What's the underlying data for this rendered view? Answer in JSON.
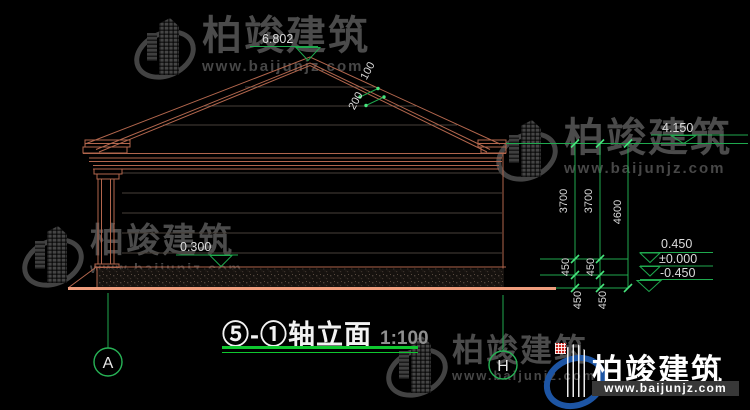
{
  "watermark": {
    "brand": "柏竣建筑",
    "url": "www.baijunjz.com"
  },
  "title_block": {
    "title": "⑤-①轴立面",
    "scale": "1:100"
  },
  "axis_bubbles": {
    "left": "A",
    "right": "H"
  },
  "levels": {
    "ridge": "6.802",
    "eave": "4.150",
    "wall_marker": "0.300",
    "plus_0450": "0.450",
    "zero": "±0.000",
    "minus_0450": "-0.450"
  },
  "dims": {
    "chain_a_3700": "3700",
    "chain_b_3700": "3700",
    "total_4600": "4600",
    "chain_a_450_upper": "450",
    "chain_b_450_upper": "450",
    "chain_a_450_lower": "450",
    "chain_b_450_lower": "450",
    "roof_200": "200",
    "roof_100": "100"
  },
  "colors": {
    "background": "#000000",
    "building_line": "#b2664d",
    "ground_line": "#ef9d7d",
    "dimension_green": "#1fa94e",
    "tick_green": "#46e57d",
    "title_underline": "#0fc72f",
    "logo_blue": "#1d55a4",
    "logo_orange": "#f69f1e",
    "logo_red": "#c9241c"
  }
}
